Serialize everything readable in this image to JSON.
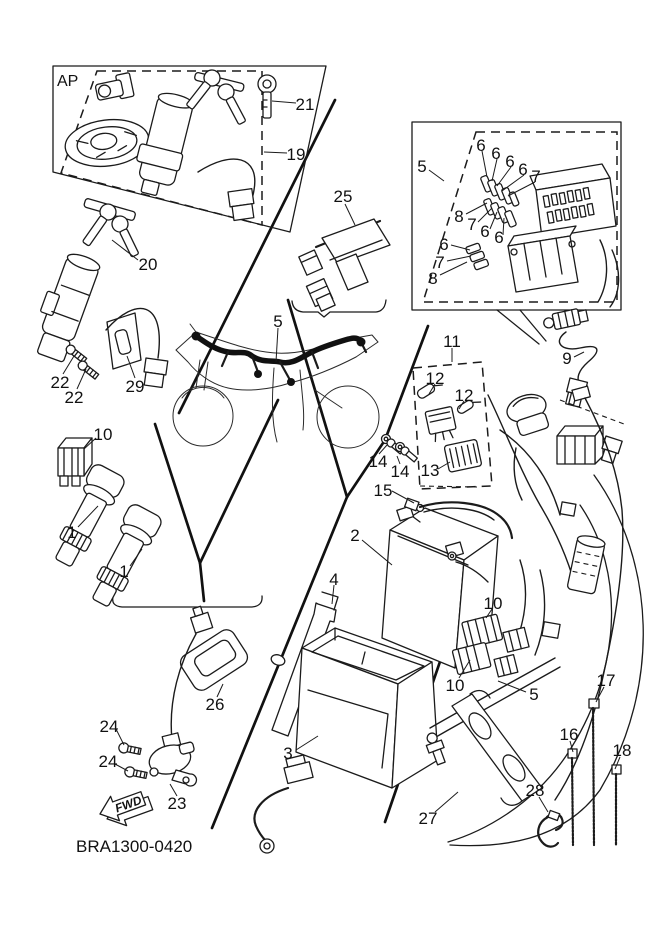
{
  "diagram": {
    "title_code": "BRA1300-0420",
    "ap_label": "AP",
    "fwd_label": "FWD",
    "line_color": "#1b1b1b",
    "bg_color": "#ffffff"
  },
  "callouts": [
    {
      "label": "21"
    },
    {
      "label": "19"
    },
    {
      "label": "20"
    },
    {
      "label": "22"
    },
    {
      "label": "22"
    },
    {
      "label": "29"
    },
    {
      "label": "25"
    },
    {
      "label": "5"
    },
    {
      "label": "6"
    },
    {
      "label": "6"
    },
    {
      "label": "6"
    },
    {
      "label": "6"
    },
    {
      "label": "7"
    },
    {
      "label": "8"
    },
    {
      "label": "7"
    },
    {
      "label": "6"
    },
    {
      "label": "6"
    },
    {
      "label": "6"
    },
    {
      "label": "7"
    },
    {
      "label": "8"
    },
    {
      "label": "9"
    },
    {
      "label": "11"
    },
    {
      "label": "12"
    },
    {
      "label": "12"
    },
    {
      "label": "13"
    },
    {
      "label": "14"
    },
    {
      "label": "14"
    },
    {
      "label": "5"
    },
    {
      "label": "15"
    },
    {
      "label": "2"
    },
    {
      "label": "4"
    },
    {
      "label": "10"
    },
    {
      "label": "10"
    },
    {
      "label": "5"
    },
    {
      "label": "3"
    },
    {
      "label": "27"
    },
    {
      "label": "1"
    },
    {
      "label": "1"
    },
    {
      "label": "10"
    },
    {
      "label": "26"
    },
    {
      "label": "24"
    },
    {
      "label": "24"
    },
    {
      "label": "23"
    },
    {
      "label": "16"
    },
    {
      "label": "17"
    },
    {
      "label": "18"
    },
    {
      "label": "28"
    }
  ]
}
